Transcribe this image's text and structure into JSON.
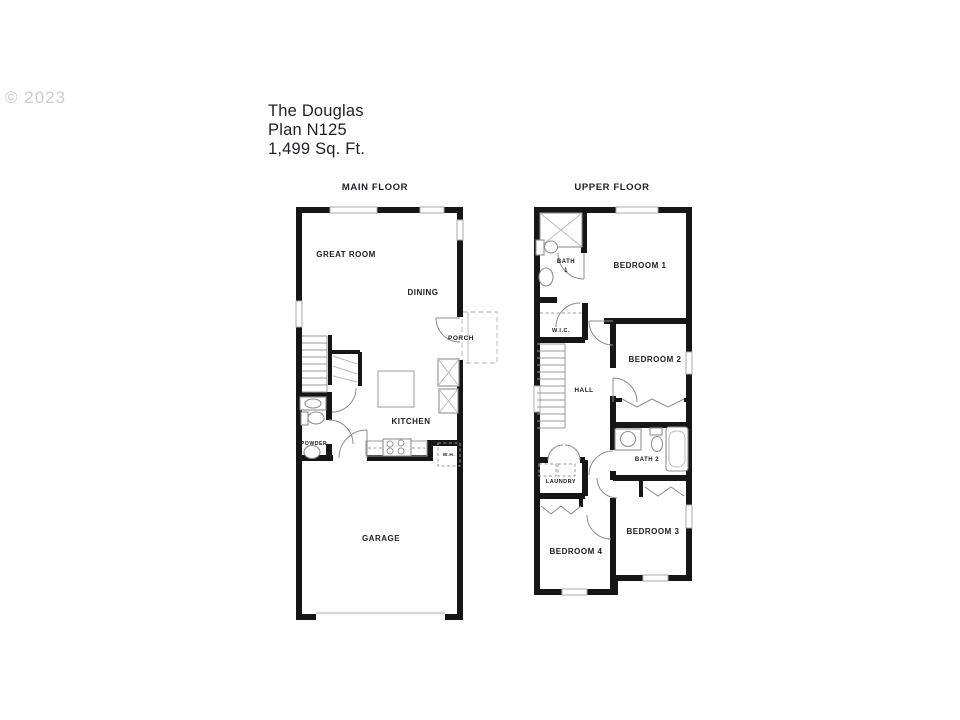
{
  "watermark": "© 2023",
  "header": {
    "name": "The Douglas",
    "plan": "Plan N125",
    "sqft": "1,499 Sq. Ft."
  },
  "main_floor": {
    "title": "MAIN FLOOR",
    "labels": {
      "great_room": "GREAT ROOM",
      "dining": "DINING",
      "porch": "PORCH",
      "kitchen": "KITCHEN",
      "powder": "POWDER",
      "water_heater": "W.H.",
      "garage": "GARAGE"
    }
  },
  "upper_floor": {
    "title": "UPPER FLOOR",
    "labels": {
      "bath1_line1": "BATH",
      "bath1_line2": "1",
      "bedroom1": "BEDROOM 1",
      "wic": "W.I.C.",
      "hall": "HALL",
      "bedroom2": "BEDROOM 2",
      "bath2": "BATH 2",
      "laundry": "LAUNDRY",
      "bedroom3": "BEDROOM 3",
      "bedroom4": "BEDROOM 4"
    }
  },
  "colors": {
    "wall": "#161616",
    "thin_line": "#9a9a9a",
    "text": "#1d1d1f",
    "watermark": "#cdcdcd"
  }
}
